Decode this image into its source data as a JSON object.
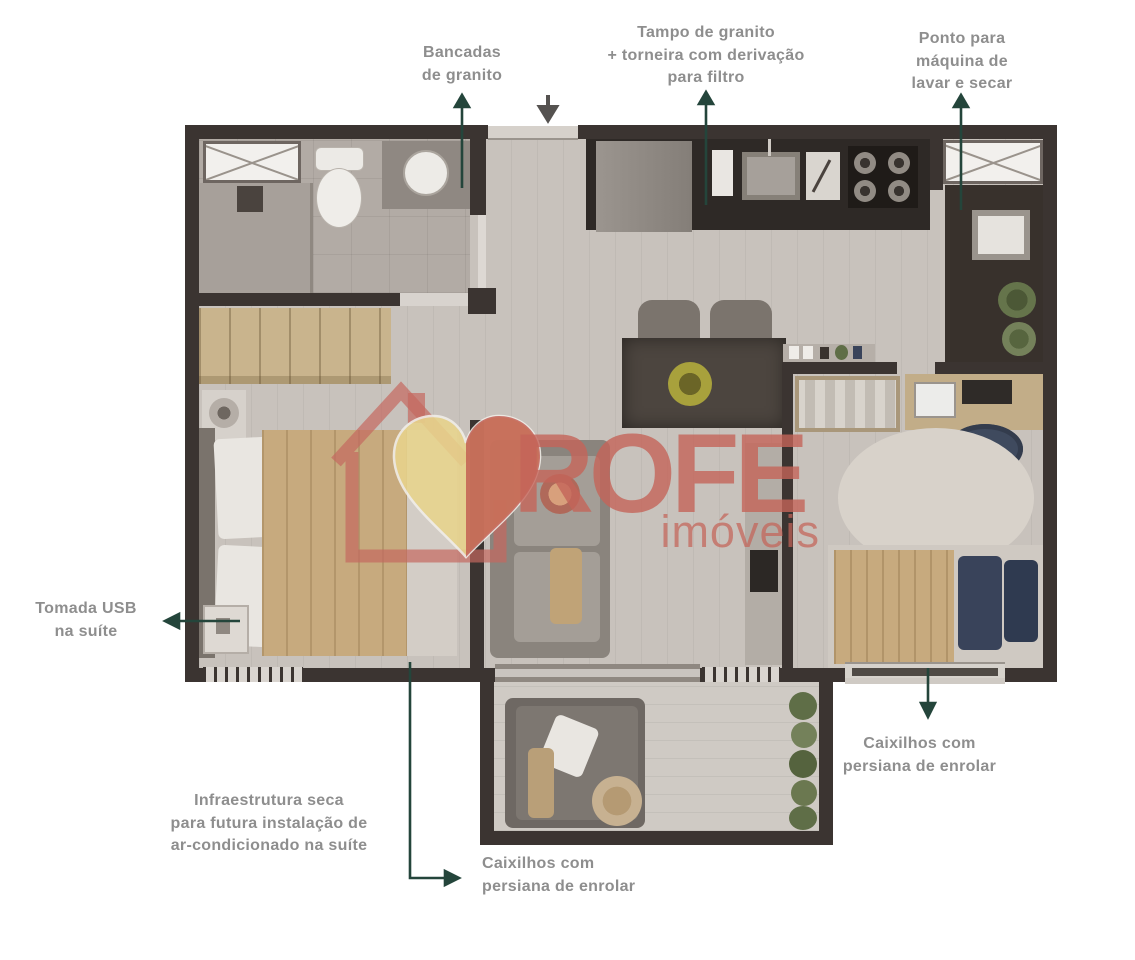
{
  "annotations": {
    "bancadas": "Bancadas\nde granito",
    "tampo": "Tampo de granito\n+ torneira com derivação\npara filtro",
    "ponto": "Ponto para\nmáquina de\nlavar e secar",
    "tomada_usb": "Tomada USB\nna suíte",
    "infraestrutura": "Infraestrutura seca\npara futura instalação de\nar-condicionado na suíte",
    "caixilhos_varanda": "Caixilhos com\npersiana de enrolar",
    "caixilhos_quarto": "Caixilhos com\npersiana de enrolar"
  },
  "watermark": {
    "brand": "ROFE",
    "subtitle": "imóveis"
  },
  "colors": {
    "wall": "#3b3431",
    "leader_line": "#24453b",
    "label_text": "#8e8e8e",
    "watermark_salmon": "#c4685f",
    "watermark_heart_yellow": "#e8d48c",
    "counter_dark": "#2e2926",
    "wood_tan": "#c7aa7e",
    "navy": "#39435a",
    "plant_green": "#5f6e47"
  }
}
